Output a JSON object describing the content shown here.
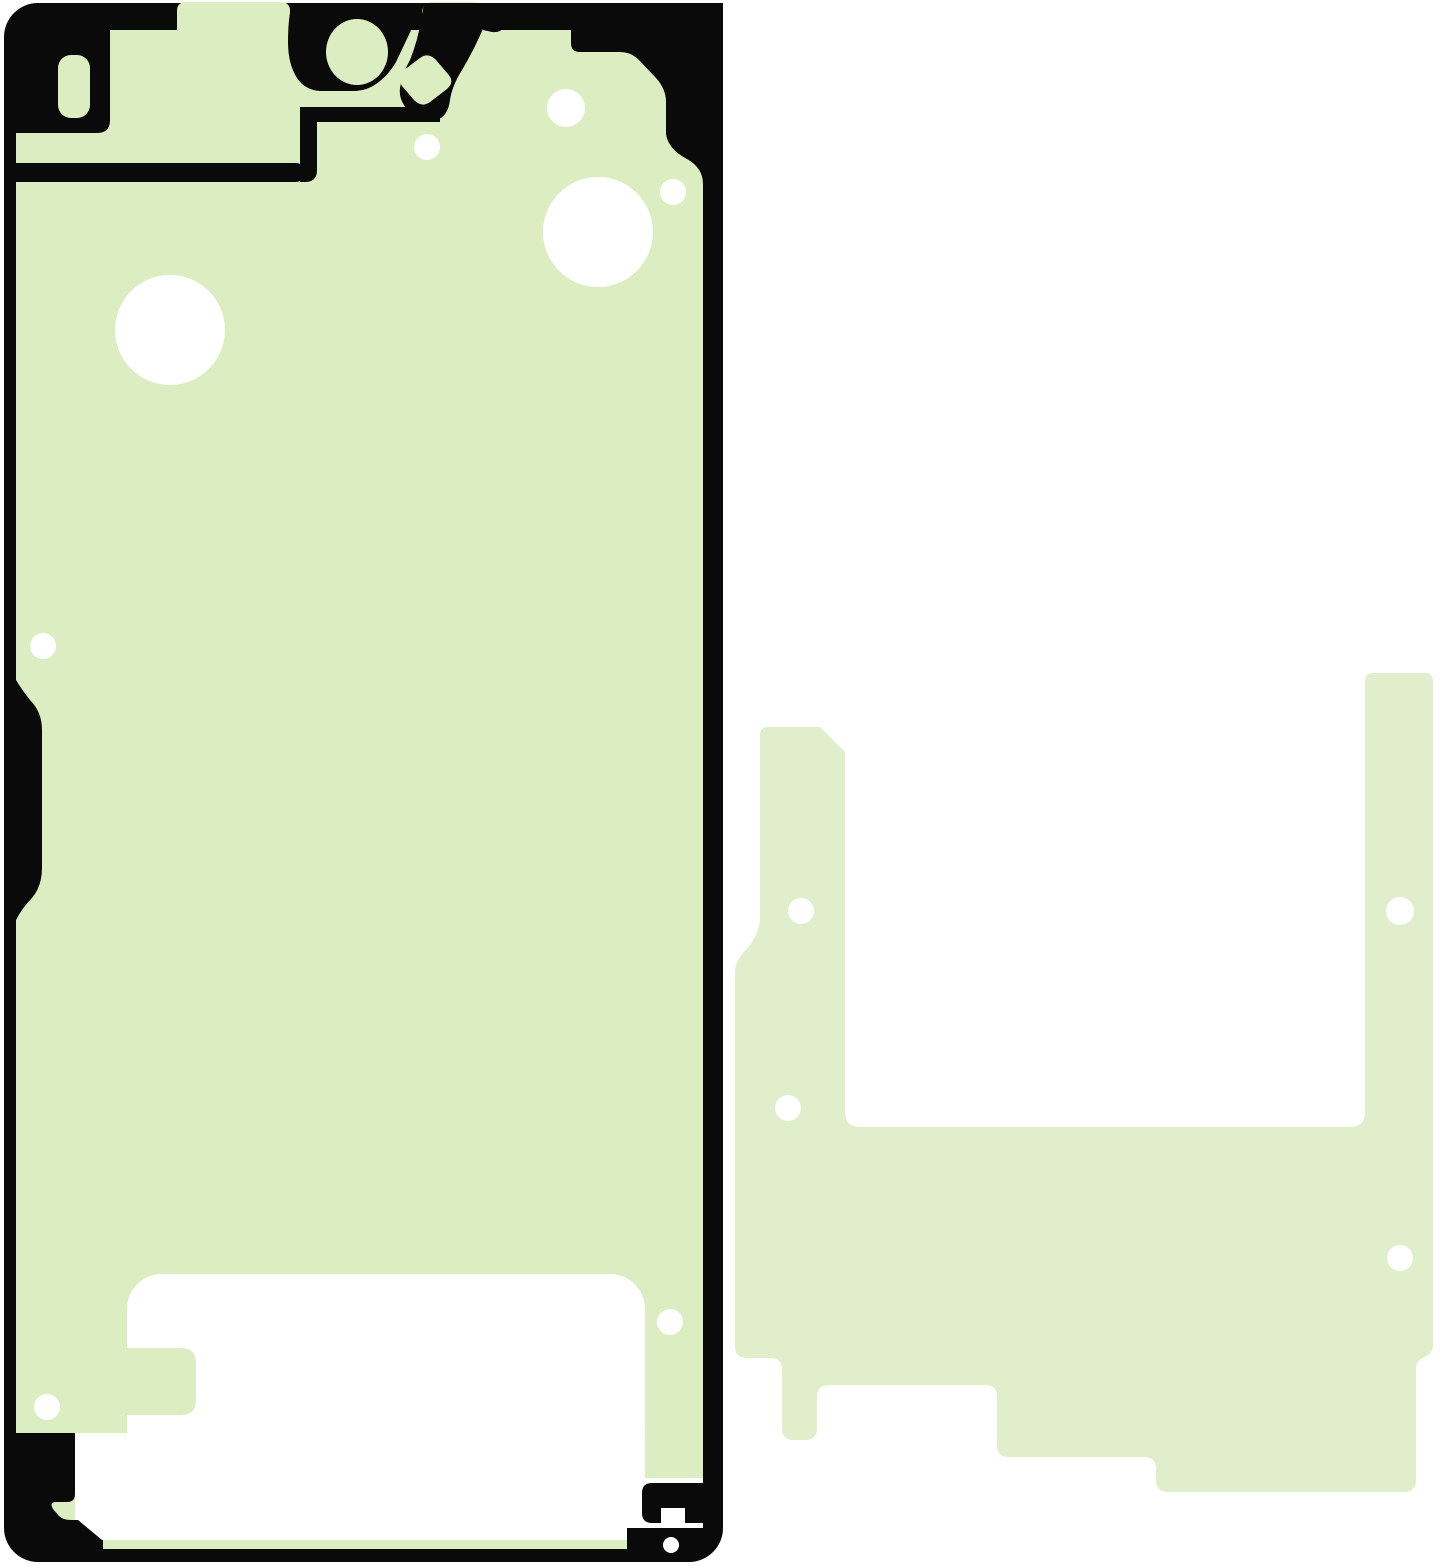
{
  "image": {
    "width": 1445,
    "height": 1566,
    "description": "Product illustration of a smartphone adhesive tape kit: left is a display/front-frame adhesive sticker (pale green with black outline frame and white punched holes), right is a lighter pale-green rear bracket adhesive foil with small white holes"
  },
  "colors": {
    "page_bg": "#ffffff",
    "black": "#0a0a0a",
    "green": "#dcedc2",
    "green2": "#e1eecb",
    "white": "#ffffff"
  },
  "shapes": [
    {
      "name": "front-adhesive-outline-frame",
      "type": "rect",
      "x": 4,
      "y": 3,
      "w": 719,
      "h": 1559,
      "rx": 34,
      "fill": "black"
    },
    {
      "name": "front-adhesive-body",
      "type": "rect",
      "x": 16,
      "y": 30,
      "w": 687,
      "h": 1510,
      "rx": 14,
      "fill": "green"
    },
    {
      "name": "top-edge-tab-left",
      "type": "rect",
      "x": 177,
      "y": 2,
      "w": 113,
      "h": 36,
      "rx": 8,
      "fill": "green"
    },
    {
      "name": "top-edge-tab-right",
      "type": "rect",
      "x": 422,
      "y": 2,
      "w": 61,
      "h": 46,
      "rx": 10,
      "fill": "green"
    },
    {
      "name": "earpiece-block",
      "type": "path",
      "d": "M16,30 L110,30 L110,120 Q110,133 97,133 L16,133 Z",
      "fill": "black"
    },
    {
      "name": "sensor-slot-window",
      "type": "rect",
      "x": 58,
      "y": 55,
      "w": 32,
      "h": 63,
      "rx": 13,
      "fill": "green"
    },
    {
      "name": "camera-blob",
      "type": "path",
      "d": "M292,3 L424,3 L396,62 Q388,76 376,84 Q368,90 356,91 L320,91 Q305,90 297,78 Q288,64 288,42 Q288,18 292,3 Z",
      "fill": "black"
    },
    {
      "name": "camera-band",
      "type": "path",
      "d": "M424,3 L493,3 Q480,40 462,70 Q452,86 450,100 Q448,116 437,120 Q424,123 412,114 Q398,102 400,88 Q402,74 410,60 Q418,40 421,20 Z",
      "fill": "black"
    },
    {
      "name": "upper-strip",
      "type": "path",
      "d": "M300,107 L440,107 L440,122 L317,122 L317,170 Q317,182 305,182 L300,182 Z",
      "fill": "black"
    },
    {
      "name": "lower-strip",
      "type": "path",
      "d": "M16,163 L295,163 Q305,163 305,172 Q305,182 295,182 L16,182 Z",
      "fill": "black"
    },
    {
      "name": "top-right-corner-block",
      "type": "path",
      "d": "M483,3 L723,3 L723,210 L703,210 L703,184 Q703,168 687,159 Q668,149 666,134 L666,102 Q666,89 656,78 L639,60 Q631,52 620,52 L580,52 Q571,52 571,43 L571,32 Q571,23 561,23 L513,23 Q505,23 503,28 Q500,33 492,32 L483,30 Z",
      "fill": "black"
    },
    {
      "name": "camera-pocket-window",
      "type": "path",
      "d": "M402,86 Q396,78 404,70 L420,58 Q428,52 436,60 L448,74 Q455,82 447,89 L430,102 Q422,108 414,100 Z",
      "fill": "green"
    },
    {
      "name": "camera-window",
      "type": "ellipse",
      "cx": 357,
      "cy": 52,
      "rx": 31,
      "ry": 33,
      "fill": "green"
    },
    {
      "name": "left-edge-bump",
      "type": "path",
      "d": "M16,680 Q22,690 30,700 Q42,712 42,730 L42,868 Q42,886 32,898 Q22,908 16,920 Z",
      "fill": "black"
    },
    {
      "name": "hole-large-left",
      "type": "circle",
      "cx": 170,
      "cy": 330,
      "r": 55,
      "fill": "white"
    },
    {
      "name": "hole-upper-mid",
      "type": "circle",
      "cx": 566,
      "cy": 108,
      "r": 19,
      "fill": "white"
    },
    {
      "name": "hole-large-right",
      "type": "circle",
      "cx": 598,
      "cy": 232,
      "r": 55,
      "fill": "white"
    },
    {
      "name": "hole-small-right",
      "type": "circle",
      "cx": 673,
      "cy": 192,
      "r": 13,
      "fill": "white"
    },
    {
      "name": "hole-dot-top",
      "type": "circle",
      "cx": 427,
      "cy": 147,
      "r": 13,
      "fill": "white"
    },
    {
      "name": "hole-dot-left-edge",
      "type": "circle",
      "cx": 43,
      "cy": 646,
      "r": 13,
      "fill": "white"
    },
    {
      "name": "bottom-window",
      "type": "rect",
      "x": 127,
      "y": 1274,
      "w": 518,
      "h": 190,
      "rx": 35,
      "fill": "white"
    },
    {
      "name": "bottom-window-tab",
      "type": "path",
      "d": "M127,1348 L181,1348 Q196,1348 196,1363 L196,1400 Q196,1415 181,1415 L127,1415 Z",
      "fill": "green"
    },
    {
      "name": "bottom-band",
      "type": "rect",
      "x": 75,
      "y": 1433,
      "w": 570,
      "h": 107,
      "fill": "white"
    },
    {
      "name": "right-strip-gap",
      "type": "rect",
      "x": 645,
      "y": 1478,
      "w": 58,
      "h": 62,
      "fill": "white"
    },
    {
      "name": "bottom-green-strip",
      "type": "rect",
      "x": 103,
      "y": 1540,
      "w": 524,
      "h": 9,
      "fill": "green"
    },
    {
      "name": "hole-bottom-left",
      "type": "circle",
      "cx": 47,
      "cy": 1407,
      "r": 13,
      "fill": "white"
    },
    {
      "name": "hole-bottom-right",
      "type": "circle",
      "cx": 670,
      "cy": 1322,
      "r": 13,
      "fill": "white"
    },
    {
      "name": "bottom-left-foot",
      "type": "path",
      "d": "M16,1433 L75,1433 L75,1494 Q75,1502 67,1502 L56,1502 Q49,1502 53,1509 L59,1516 Q63,1520 71,1520 L78,1520 L102,1540 L16,1540 Z",
      "fill": "black"
    },
    {
      "name": "bottom-right-foot-upper",
      "type": "path",
      "d": "M703,1483 L652,1483 Q642,1483 642,1493 L642,1513 Q642,1523 652,1523 L703,1523 Z",
      "fill": "black"
    },
    {
      "name": "bottom-right-foot-notch",
      "type": "rect",
      "x": 661,
      "y": 1508,
      "w": 24,
      "h": 15,
      "fill": "white"
    },
    {
      "name": "bottom-right-foot-lower",
      "type": "rect",
      "x": 627,
      "y": 1528,
      "w": 76,
      "h": 12,
      "fill": "black"
    },
    {
      "name": "bottom-right-notch-dot",
      "type": "circle",
      "cx": 671,
      "cy": 1545,
      "r": 8,
      "fill": "white"
    },
    {
      "name": "rear-adhesive-body",
      "type": "path",
      "d": "M768,727 L820,727 L845,752 L845,1112 Q845,1127 860,1127 L1350,1127 Q1365,1127 1365,1112 L1365,681 Q1365,673 1373,673 L1425,673 Q1433,673 1433,681 L1433,1346 Q1433,1352 1428,1355 L1421,1359 Q1416,1362 1416,1368 L1416,1480 Q1416,1492 1404,1492 L1168,1492 Q1156,1492 1156,1480 L1156,1469 Q1156,1457 1144,1457 L1009,1457 Q997,1457 997,1445 L997,1397 Q997,1385 985,1385 L829,1385 Q817,1385 817,1397 L817,1428 Q817,1440 805,1440 L794,1440 Q782,1440 782,1428 L782,1370 Q782,1358 770,1358 L747,1358 Q735,1358 735,1346 L735,972 Q735,962 743,953 Q758,938 760,920 L760,735 Q760,727 768,727 Z",
      "fill": "green2"
    },
    {
      "name": "rear-hole-top-left",
      "type": "circle",
      "cx": 801,
      "cy": 911,
      "r": 13,
      "fill": "white"
    },
    {
      "name": "rear-hole-lower-left",
      "type": "circle",
      "cx": 788,
      "cy": 1108,
      "r": 13,
      "fill": "white"
    },
    {
      "name": "rear-hole-top-right",
      "type": "circle",
      "cx": 1400,
      "cy": 911,
      "r": 14,
      "fill": "white"
    },
    {
      "name": "rear-hole-lower-right",
      "type": "circle",
      "cx": 1400,
      "cy": 1258,
      "r": 13,
      "fill": "white"
    }
  ]
}
